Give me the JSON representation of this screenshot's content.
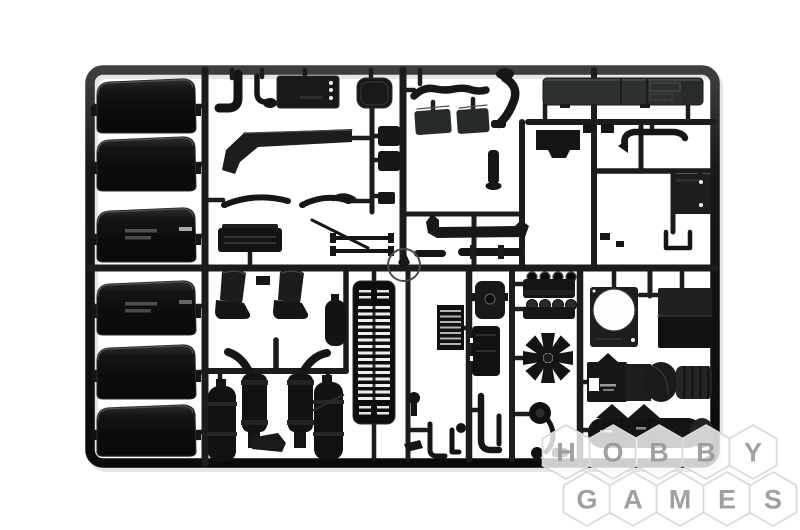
{
  "page": {
    "background": "#ffffff",
    "description": "Product photograph of a black injection-molded plastic model kit sprue (truck parts) on a white background with a HOBBY GAMES hexagonal watermark in the lower right corner"
  },
  "colors": {
    "plastic": "#141414",
    "plastic_dark": "#0d0d0d",
    "plastic_light_panel": "#2e3230",
    "frame_highlight": "#3e3e3e",
    "watermark_letter": "#999999",
    "watermark_cell_fill": "rgba(255,255,255,0.8)",
    "watermark_cell_border": "#d8d8d8"
  },
  "watermark": {
    "line1": "HOBBY",
    "line2": "GAMES",
    "rows": [
      [
        "H",
        "O",
        "B",
        "B",
        "Y"
      ],
      [
        "G",
        "A",
        "M",
        "E",
        "S"
      ]
    ]
  },
  "sprue": {
    "material": "black styrene plastic",
    "parts": [
      "mudguard-fenders-x6",
      "l-shaped-pipe",
      "j-hook-pipe",
      "panel-with-holes",
      "rounded-square-panel",
      "chassis-side-beam",
      "leaf-springs",
      "ribbed-step-box",
      "axle-rods",
      "engine-block-pair",
      "wavy-exhaust-pipe",
      "s-bend-pipe",
      "seat-back-panels",
      "sleeper-cab-panel",
      "intake-elbow-pipe",
      "engine-mount",
      "vent-panel-with-holes",
      "u-bracket",
      "muffler-pipe",
      "pipe-segments",
      "flanged-stub",
      "gate-ring-marker",
      "bucket-seats",
      "exhaust-mufflers-with-curved-pipes",
      "air-tanks",
      "wedge-muffler",
      "radiator-grille",
      "small-radiator",
      "hook-parts",
      "valve-cover",
      "gearbox-block",
      "j-hook-pipe-large",
      "cylinder-head-upper",
      "cylinder-head-lower",
      "cooling-fan",
      "fan-shroud-panel",
      "radiator-panel",
      "engine-transmission-assembly",
      "fuel-tank",
      "pulley-and-belt",
      "ball-joint-parts",
      "small-knob-parts"
    ]
  }
}
